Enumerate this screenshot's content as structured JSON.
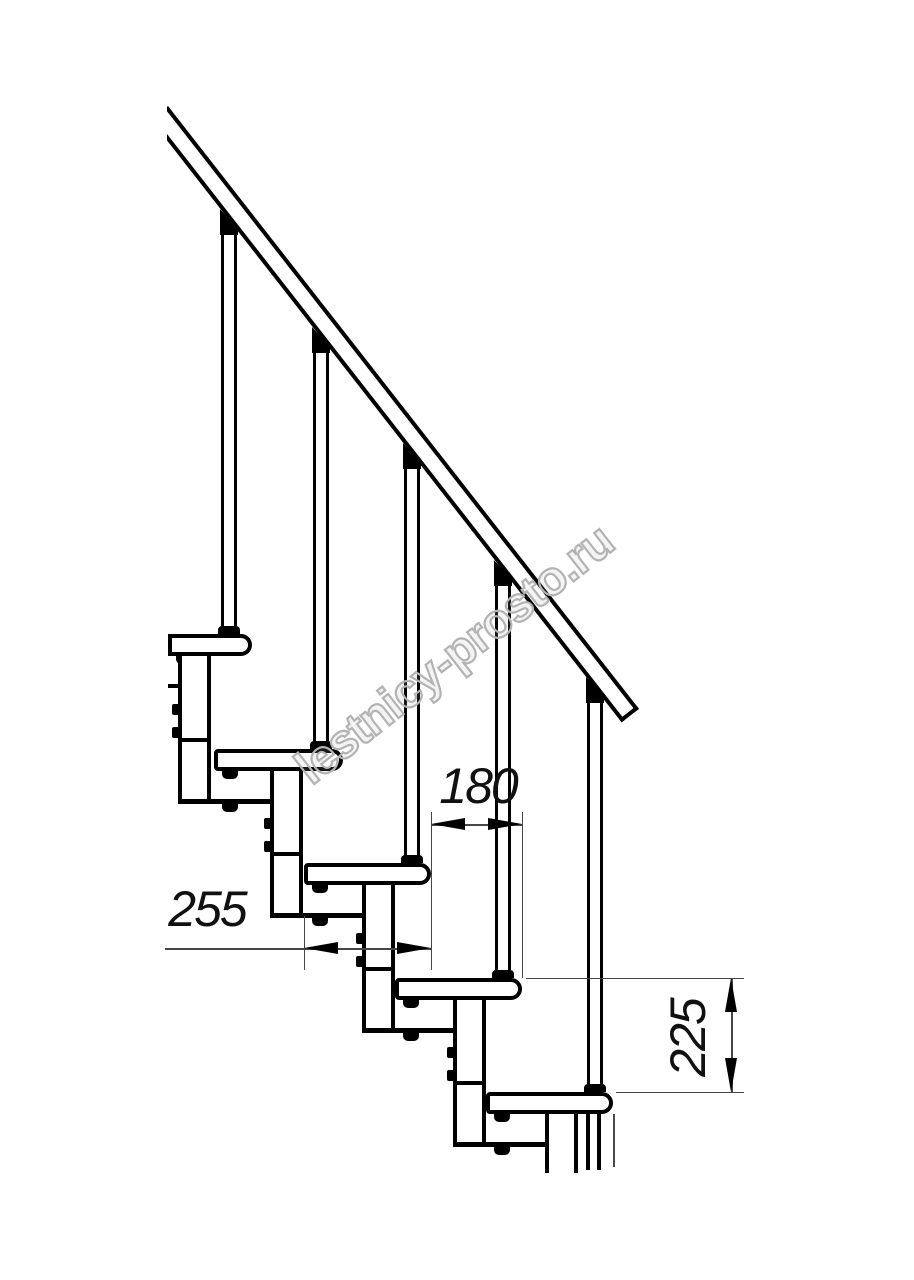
{
  "watermark": {
    "text": "lestnicy-prosto.ru",
    "color": "#b3b3b3",
    "angle_deg": -38,
    "center_x": 455,
    "center_y": 655,
    "font_size": 48
  },
  "drawing": {
    "background": "#ffffff",
    "line_color": "#000000",
    "thin_line_color": "#464646",
    "handrail": {
      "x": 168,
      "y": 106,
      "length": 765,
      "thickness": 22,
      "angle_deg": 52
    },
    "tread_height": 22,
    "module_width": 33,
    "treads": [
      {
        "left": 168,
        "right": 252,
        "top": 634,
        "crop_left": true
      },
      {
        "left": 214,
        "right": 343,
        "top": 749,
        "crop_left": false
      },
      {
        "left": 304,
        "right": 431,
        "top": 863,
        "crop_left": false
      },
      {
        "left": 395,
        "right": 522,
        "top": 978,
        "crop_left": false
      },
      {
        "left": 486,
        "right": 613,
        "top": 1092,
        "crop_left": false
      }
    ],
    "modules": [
      {
        "left": 178,
        "top": 656,
        "bottom": 799,
        "joint": 738,
        "bolts": [
          704,
          727
        ],
        "bracket_right": 270,
        "tab_x": 222,
        "open": false
      },
      {
        "left": 270,
        "top": 771,
        "bottom": 913,
        "joint": 852,
        "bolts": [
          818,
          841
        ],
        "bracket_right": 362,
        "tab_x": 312,
        "open": false
      },
      {
        "left": 362,
        "top": 885,
        "bottom": 1028,
        "joint": 967,
        "bolts": [
          933,
          956
        ],
        "bracket_right": 453,
        "tab_x": 403,
        "open": false
      },
      {
        "left": 453,
        "top": 1000,
        "bottom": 1142,
        "joint": 1081,
        "bolts": [
          1047,
          1070
        ],
        "bracket_right": 545,
        "tab_x": 494,
        "open": false
      },
      {
        "left": 545,
        "top": 1114,
        "bottom": 1173,
        "joint": 0,
        "bolts": [],
        "bracket_right": 0,
        "tab_x": 0,
        "open": true
      }
    ],
    "balusters": [
      {
        "cx": 229,
        "rail_y": 220,
        "tread_top": 634
      },
      {
        "cx": 321,
        "rail_y": 338,
        "tread_top": 749
      },
      {
        "cx": 412,
        "rail_y": 454,
        "tread_top": 863
      },
      {
        "cx": 503,
        "rail_y": 571,
        "tread_top": 978
      },
      {
        "cx": 595,
        "rail_y": 688,
        "tread_top": 1092
      }
    ],
    "stub_line": {
      "x1": 168,
      "x2": 178,
      "y": 684
    },
    "cut_lines": [
      {
        "x": 586,
        "w": 4,
        "y1": 1114,
        "y2": 1170,
        "thin": false
      },
      {
        "x": 597,
        "w": 4,
        "y1": 1114,
        "y2": 1170,
        "thin": false
      },
      {
        "x": 613,
        "w": 2,
        "y1": 1114,
        "y2": 1167,
        "thin": true
      }
    ]
  },
  "dimensions": [
    {
      "id": "step-run",
      "label": "180",
      "value": 180,
      "line": {
        "dir": "h",
        "y": 824,
        "x1": 431,
        "x2": 522
      },
      "arrows": [
        {
          "x": 431,
          "y": 824,
          "dir": "left"
        },
        {
          "x": 522,
          "y": 824,
          "dir": "right"
        }
      ],
      "exts": [
        {
          "dir": "v",
          "x": 431,
          "y1": 812,
          "y2": 970
        },
        {
          "dir": "v",
          "x": 522,
          "y1": 812,
          "y2": 978
        }
      ],
      "label_x": 478,
      "label_y": 786,
      "rotated": false
    },
    {
      "id": "tread-depth",
      "label": "255",
      "value": 255,
      "line": {
        "dir": "h",
        "y": 948,
        "x1": 165,
        "x2": 431
      },
      "arrows": [
        {
          "x": 304,
          "y": 948,
          "dir": "left"
        },
        {
          "x": 431,
          "y": 948,
          "dir": "right"
        }
      ],
      "exts": [
        {
          "dir": "v",
          "x": 304,
          "y1": 916,
          "y2": 970
        }
      ],
      "label_x": 207,
      "label_y": 909,
      "rotated": false
    },
    {
      "id": "step-rise",
      "label": "225",
      "value": 225,
      "line": {
        "dir": "v",
        "x": 731,
        "y1": 978,
        "y2": 1092
      },
      "arrows": [
        {
          "x": 731,
          "y": 978,
          "dir": "up"
        },
        {
          "x": 731,
          "y": 1092,
          "dir": "down"
        }
      ],
      "exts": [
        {
          "dir": "h",
          "y": 978,
          "x1": 526,
          "x2": 744
        },
        {
          "dir": "h",
          "y": 1092,
          "x1": 616,
          "x2": 744
        }
      ],
      "label_x": 688,
      "label_y": 1038,
      "rotated": true
    }
  ]
}
